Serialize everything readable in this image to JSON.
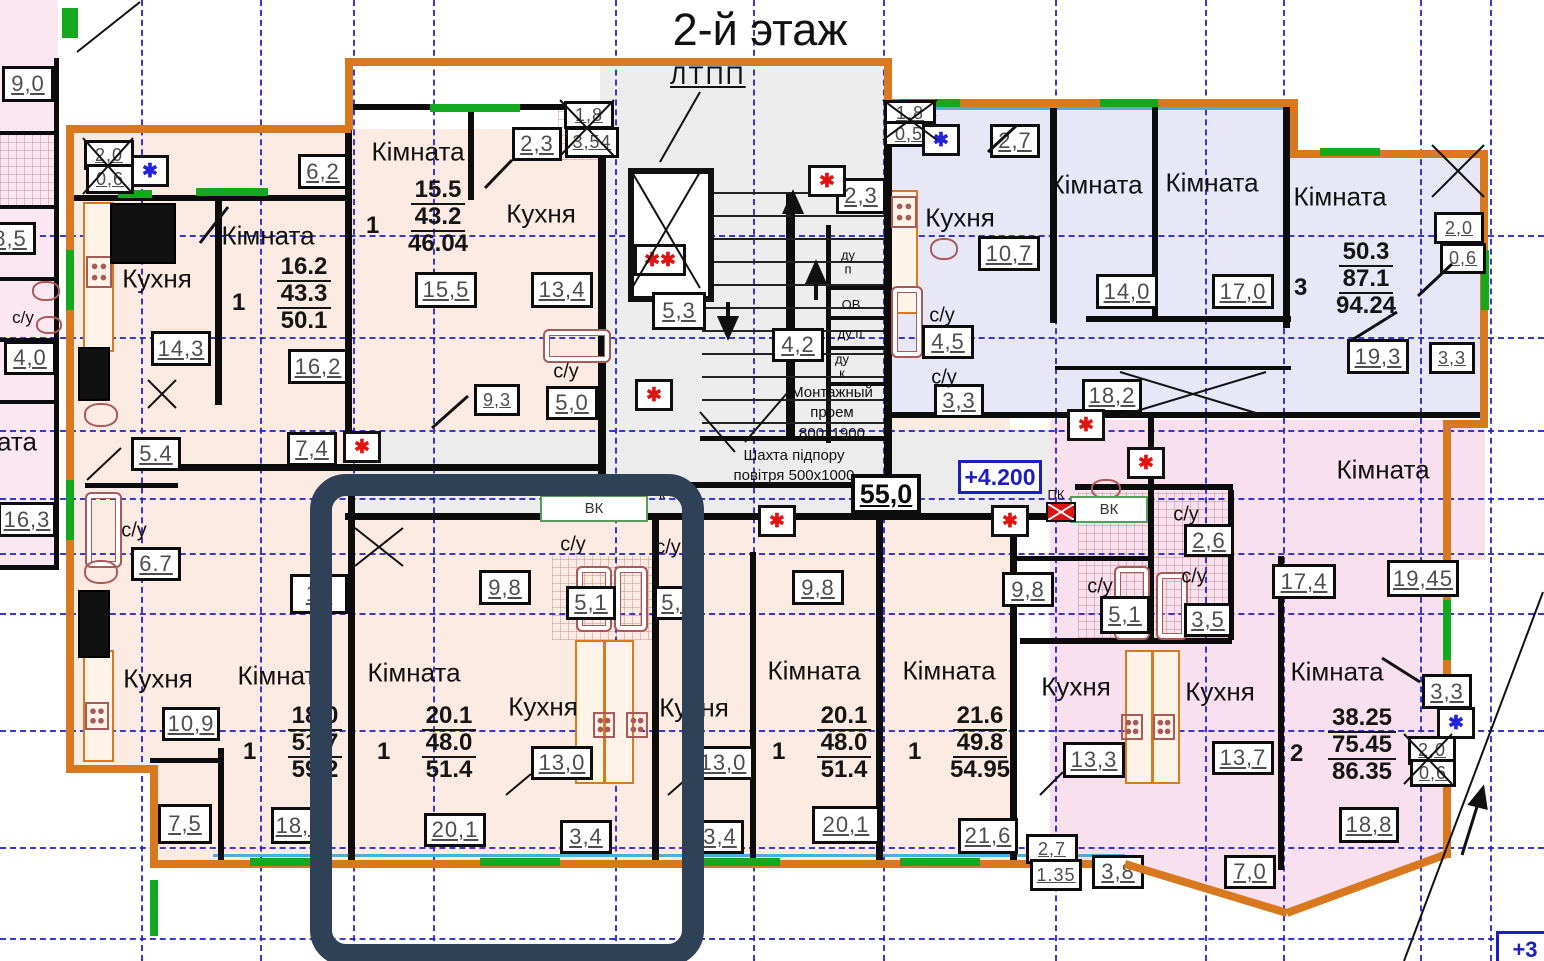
{
  "title": "2-й этаж",
  "stair_label": "ЛТПП",
  "notes": {
    "mount": [
      "Монтажный",
      "проем",
      "800х1900"
    ],
    "shaft": [
      "Шахта підпору",
      "повітря 500х1000"
    ]
  },
  "elevations": {
    "current": "+4.200",
    "corner": "+3",
    "corridor_area": "55,0"
  },
  "vk_labels": [
    {
      "t": "ВК",
      "x": 540,
      "y": 495,
      "w": 104,
      "h": 23
    },
    {
      "t": "ВК",
      "x": 1070,
      "y": 496,
      "w": 74,
      "h": 23
    }
  ],
  "text_labels": [
    {
      "t": "Кімната",
      "x": 268,
      "y": 236,
      "s": 26
    },
    {
      "t": "Кухня",
      "x": 157,
      "y": 279,
      "s": 26
    },
    {
      "t": "Кімната",
      "x": 418,
      "y": 152,
      "s": 26
    },
    {
      "t": "Кухня",
      "x": 541,
      "y": 214,
      "s": 26
    },
    {
      "t": "Кухня",
      "x": 960,
      "y": 218,
      "s": 26
    },
    {
      "t": "Кімната",
      "x": 1096,
      "y": 185,
      "s": 26
    },
    {
      "t": "Кімната",
      "x": 1212,
      "y": 183,
      "s": 26
    },
    {
      "t": "Кімната",
      "x": 1340,
      "y": 197,
      "s": 26
    },
    {
      "t": "Кімната",
      "x": 1383,
      "y": 470,
      "s": 26
    },
    {
      "t": "Кімната",
      "x": 284,
      "y": 676,
      "s": 26
    },
    {
      "t": "Кухня",
      "x": 158,
      "y": 679,
      "s": 26
    },
    {
      "t": "Кімната",
      "x": 414,
      "y": 673,
      "s": 26
    },
    {
      "t": "Кухня",
      "x": 543,
      "y": 707,
      "s": 26
    },
    {
      "t": "Кухня",
      "x": 694,
      "y": 708,
      "s": 26
    },
    {
      "t": "Кімната",
      "x": 814,
      "y": 671,
      "s": 26
    },
    {
      "t": "Кімната",
      "x": 949,
      "y": 671,
      "s": 26
    },
    {
      "t": "Кухня",
      "x": 1076,
      "y": 687,
      "s": 26
    },
    {
      "t": "Кухня",
      "x": 1220,
      "y": 692,
      "s": 26
    },
    {
      "t": "Кімната",
      "x": 1337,
      "y": 672,
      "s": 26
    },
    {
      "t": "ата",
      "x": 17,
      "y": 442,
      "s": 26
    },
    {
      "t": "с/у",
      "x": 23,
      "y": 318,
      "s": 17
    },
    {
      "t": "с/у",
      "x": 566,
      "y": 372,
      "s": 20
    },
    {
      "t": "с/у",
      "x": 134,
      "y": 531,
      "s": 20
    },
    {
      "t": "с/у",
      "x": 942,
      "y": 316,
      "s": 20
    },
    {
      "t": "с/у",
      "x": 944,
      "y": 378,
      "s": 20
    },
    {
      "t": "с/у",
      "x": 573,
      "y": 545,
      "s": 20
    },
    {
      "t": "с/у",
      "x": 668,
      "y": 548,
      "s": 20
    },
    {
      "t": "с/у",
      "x": 1186,
      "y": 515,
      "s": 20
    },
    {
      "t": "с/у",
      "x": 1194,
      "y": 577,
      "s": 20
    },
    {
      "t": "с/у",
      "x": 1100,
      "y": 587,
      "s": 20
    },
    {
      "t": "ду\nп",
      "x": 848,
      "y": 262,
      "s": 13
    },
    {
      "t": "ОВ",
      "x": 851,
      "y": 305,
      "s": 13
    },
    {
      "t": "ду п",
      "x": 850,
      "y": 334,
      "s": 13
    },
    {
      "t": "ду\nк",
      "x": 842,
      "y": 366,
      "s": 13
    },
    {
      "t": "ПК",
      "x": 1056,
      "y": 495,
      "s": 13
    },
    {
      "t": "к",
      "x": 662,
      "y": 494,
      "s": 14
    }
  ],
  "area_boxes": [
    {
      "v": "9,0",
      "x": 2,
      "y": 66,
      "w": 46,
      "h": 30
    },
    {
      "v": "8,5",
      "x": -16,
      "y": 222,
      "w": 46,
      "h": 27
    },
    {
      "v": "4,0",
      "x": 4,
      "y": 341,
      "w": 46,
      "h": 28
    },
    {
      "v": "16,3",
      "x": -2,
      "y": 502,
      "w": 52,
      "h": 29
    },
    {
      "v": "2,0",
      "x": 84,
      "y": 140,
      "w": 44,
      "h": 24
    },
    {
      "v": "0,6",
      "x": 86,
      "y": 164,
      "w": 42,
      "h": 24
    },
    {
      "v": "6,2",
      "x": 298,
      "y": 154,
      "w": 44,
      "h": 29
    },
    {
      "v": "16,2",
      "x": 288,
      "y": 349,
      "w": 54,
      "h": 29
    },
    {
      "v": "14,3",
      "x": 151,
      "y": 331,
      "w": 54,
      "h": 29
    },
    {
      "v": "7,4",
      "x": 287,
      "y": 432,
      "w": 44,
      "h": 28
    },
    {
      "v": "5.4",
      "x": 131,
      "y": 437,
      "w": 44,
      "h": 28
    },
    {
      "v": "6.7",
      "x": 131,
      "y": 547,
      "w": 44,
      "h": 28
    },
    {
      "v": "15,5",
      "x": 415,
      "y": 272,
      "w": 56,
      "h": 30
    },
    {
      "v": "13,4",
      "x": 531,
      "y": 272,
      "w": 56,
      "h": 30
    },
    {
      "v": "2,3",
      "x": 512,
      "y": 127,
      "w": 44,
      "h": 28
    },
    {
      "v": "1,8",
      "x": 564,
      "y": 101,
      "w": 44,
      "h": 22
    },
    {
      "v": "3,54",
      "x": 565,
      "y": 127,
      "w": 48,
      "h": 25
    },
    {
      "v": "9,3",
      "x": 474,
      "y": 384,
      "w": 40,
      "h": 26
    },
    {
      "v": "5,0",
      "x": 546,
      "y": 386,
      "w": 46,
      "h": 28
    },
    {
      "v": "2,3",
      "x": 836,
      "y": 178,
      "w": 44,
      "h": 30
    },
    {
      "v": "5,3",
      "x": 652,
      "y": 292,
      "w": 48,
      "h": 32
    },
    {
      "v": "4,2",
      "x": 772,
      "y": 328,
      "w": 46,
      "h": 28
    },
    {
      "v": "1,8",
      "x": 884,
      "y": 100,
      "w": 46,
      "h": 21
    },
    {
      "v": "0,5",
      "x": 884,
      "y": 121,
      "w": 44,
      "h": 20
    },
    {
      "v": "2,7",
      "x": 990,
      "y": 124,
      "w": 44,
      "h": 28
    },
    {
      "v": "10,7",
      "x": 978,
      "y": 236,
      "w": 56,
      "h": 29
    },
    {
      "v": "4,5",
      "x": 922,
      "y": 325,
      "w": 46,
      "h": 28
    },
    {
      "v": "3,3",
      "x": 934,
      "y": 384,
      "w": 44,
      "h": 28
    },
    {
      "v": "14,0",
      "x": 1096,
      "y": 274,
      "w": 56,
      "h": 29
    },
    {
      "v": "17,0",
      "x": 1212,
      "y": 274,
      "w": 56,
      "h": 29
    },
    {
      "v": "18,2",
      "x": 1082,
      "y": 379,
      "w": 54,
      "h": 28
    },
    {
      "v": "19,3",
      "x": 1347,
      "y": 339,
      "w": 56,
      "h": 29
    },
    {
      "v": "3,3",
      "x": 1429,
      "y": 342,
      "w": 40,
      "h": 26
    },
    {
      "v": "2,0",
      "x": 1434,
      "y": 212,
      "w": 44,
      "h": 26
    },
    {
      "v": "0,6",
      "x": 1440,
      "y": 243,
      "w": 40,
      "h": 25
    },
    {
      "v": "9,8",
      "x": 479,
      "y": 570,
      "w": 46,
      "h": 29
    },
    {
      "v": "5,1",
      "x": 566,
      "y": 586,
      "w": 44,
      "h": 28
    },
    {
      "v": "5,1",
      "x": 654,
      "y": 586,
      "w": 42,
      "h": 28
    },
    {
      "v": "9,8",
      "x": 792,
      "y": 570,
      "w": 46,
      "h": 29
    },
    {
      "v": "9,8",
      "x": 1002,
      "y": 572,
      "w": 46,
      "h": 29
    },
    {
      "v": "2,6",
      "x": 1184,
      "y": 524,
      "w": 44,
      "h": 27
    },
    {
      "v": "5,1",
      "x": 1100,
      "y": 596,
      "w": 44,
      "h": 32
    },
    {
      "v": "3,5",
      "x": 1184,
      "y": 603,
      "w": 42,
      "h": 28
    },
    {
      "v": "17,4",
      "x": 1272,
      "y": 564,
      "w": 58,
      "h": 29
    },
    {
      "v": "19,45",
      "x": 1387,
      "y": 560,
      "w": 66,
      "h": 31
    },
    {
      "v": "16",
      "x": 290,
      "y": 574,
      "w": 52,
      "h": 34
    },
    {
      "v": "10,9",
      "x": 162,
      "y": 707,
      "w": 52,
      "h": 28
    },
    {
      "v": "7,5",
      "x": 158,
      "y": 804,
      "w": 48,
      "h": 34
    },
    {
      "v": "18,0",
      "x": 271,
      "y": 807,
      "w": 50,
      "h": 31
    },
    {
      "v": "20,1",
      "x": 424,
      "y": 813,
      "w": 56,
      "h": 28
    },
    {
      "v": "13,0",
      "x": 531,
      "y": 746,
      "w": 56,
      "h": 28
    },
    {
      "v": "13,0",
      "x": 692,
      "y": 746,
      "w": 56,
      "h": 28
    },
    {
      "v": "3,4",
      "x": 560,
      "y": 820,
      "w": 46,
      "h": 28
    },
    {
      "v": "3,4",
      "x": 696,
      "y": 820,
      "w": 42,
      "h": 28
    },
    {
      "v": "20,1",
      "x": 812,
      "y": 806,
      "w": 62,
      "h": 32
    },
    {
      "v": "21,6",
      "x": 958,
      "y": 818,
      "w": 54,
      "h": 30
    },
    {
      "v": "13,3",
      "x": 1063,
      "y": 742,
      "w": 56,
      "h": 30
    },
    {
      "v": "13,7",
      "x": 1212,
      "y": 741,
      "w": 56,
      "h": 28
    },
    {
      "v": "18,8",
      "x": 1339,
      "y": 807,
      "w": 54,
      "h": 30
    },
    {
      "v": "3,3",
      "x": 1422,
      "y": 674,
      "w": 44,
      "h": 29
    },
    {
      "v": "2,0",
      "x": 1408,
      "y": 736,
      "w": 42,
      "h": 23
    },
    {
      "v": "0,6",
      "x": 1410,
      "y": 759,
      "w": 40,
      "h": 22
    },
    {
      "v": "2,7",
      "x": 1026,
      "y": 834,
      "w": 46,
      "h": 24
    },
    {
      "v": "1.35",
      "x": 1030,
      "y": 859,
      "w": 46,
      "h": 26
    },
    {
      "v": "3,8",
      "x": 1092,
      "y": 855,
      "w": 46,
      "h": 28
    },
    {
      "v": "7,0",
      "x": 1224,
      "y": 855,
      "w": 46,
      "h": 28
    }
  ],
  "stats": [
    {
      "rooms": "1",
      "a1": "16.2",
      "a2": "43.3",
      "a3": "50.1",
      "x": 232,
      "y": 253
    },
    {
      "rooms": "1",
      "a1": "15.5",
      "a2": "43.2",
      "a3": "46.04",
      "x": 366,
      "y": 176
    },
    {
      "rooms": "3",
      "a1": "50.3",
      "a2": "87.1",
      "a3": "94.24",
      "x": 1294,
      "y": 238
    },
    {
      "rooms": "1",
      "a1": "18.0",
      "a2": "51.7",
      "a3": "59.2",
      "x": 243,
      "y": 702
    },
    {
      "rooms": "1",
      "a1": "20.1",
      "a2": "48.0",
      "a3": "51.4",
      "x": 377,
      "y": 702
    },
    {
      "rooms": "1",
      "a1": "20.1",
      "a2": "48.0",
      "a3": "51.4",
      "x": 772,
      "y": 702
    },
    {
      "rooms": "1",
      "a1": "21.6",
      "a2": "49.8",
      "a3": "54.95",
      "x": 908,
      "y": 702
    },
    {
      "rooms": "2",
      "a1": "38.25",
      "a2": "75.45",
      "a3": "86.35",
      "x": 1290,
      "y": 704
    }
  ],
  "markers": {
    "red": [
      [
        343,
        431
      ],
      [
        635,
        379
      ],
      [
        808,
        165
      ],
      [
        758,
        505
      ],
      [
        991,
        505
      ],
      [
        1067,
        409
      ],
      [
        1127,
        447
      ]
    ],
    "blue": [
      [
        131,
        155
      ],
      [
        922,
        124
      ],
      [
        1437,
        707
      ]
    ],
    "red_double": [
      [
        634,
        244
      ]
    ],
    "red_box": [
      [
        1046,
        502
      ]
    ]
  }
}
